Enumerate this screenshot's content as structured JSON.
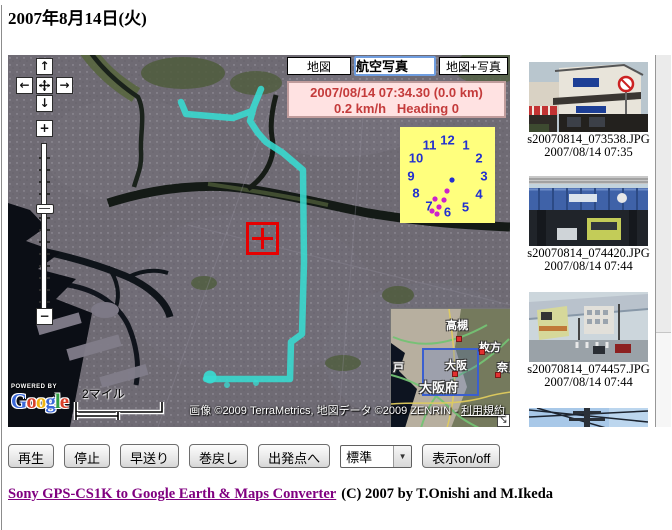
{
  "page": {
    "title": "2007年8月14日(火)"
  },
  "icons": {
    "pan_up": "↑",
    "pan_left": "←",
    "pan_right": "→",
    "pan_down": "↓",
    "zoom_in": "+",
    "zoom_out": "−",
    "select_arrow": "▼",
    "overview_collapse": "↘"
  },
  "map": {
    "type_buttons": [
      {
        "label": "地図",
        "selected": false
      },
      {
        "label": "航空写真",
        "selected": true
      },
      {
        "label": "地図+写真",
        "selected": false
      }
    ],
    "status": {
      "line1": "2007/08/14 07:34.30 (0.0 km)",
      "line2": "0.2 km/h   Heading 0"
    },
    "clock": {
      "numbers": [
        "1",
        "2",
        "3",
        "4",
        "5",
        "6",
        "7",
        "8",
        "9",
        "10",
        "11",
        "12"
      ],
      "center_dot": [
        52,
        53
      ],
      "hand_dots": [
        [
          47,
          64
        ],
        [
          44,
          73
        ],
        [
          35,
          72
        ],
        [
          39,
          80
        ],
        [
          32,
          84
        ],
        [
          37,
          87
        ]
      ]
    },
    "track": {
      "color": "#38dcd2",
      "points": [
        [
          173,
          47
        ],
        [
          178,
          59
        ],
        [
          225,
          63
        ],
        [
          244,
          56
        ],
        [
          253,
          34
        ],
        [
          246,
          51
        ],
        [
          242,
          66
        ],
        [
          250,
          78
        ],
        [
          258,
          87
        ],
        [
          275,
          98
        ],
        [
          295,
          115
        ],
        [
          296,
          207
        ],
        [
          294,
          279
        ],
        [
          283,
          287
        ],
        [
          282,
          324
        ],
        [
          198,
          324
        ]
      ],
      "end_dot": [
        202,
        322
      ],
      "stray_dots": [
        [
          219,
          330
        ],
        [
          248,
          328
        ]
      ]
    },
    "scale_label": "2マイル",
    "google_logo": {
      "powered_by": "POWERED BY",
      "letters": [
        {
          "ch": "G",
          "color": "#3b68d8"
        },
        {
          "ch": "o",
          "color": "#d8402a"
        },
        {
          "ch": "o",
          "color": "#f0b411"
        },
        {
          "ch": "g",
          "color": "#3b68d8"
        },
        {
          "ch": "l",
          "color": "#2f9e44"
        },
        {
          "ch": "e",
          "color": "#d8402a"
        }
      ]
    },
    "attribution": {
      "text": "画像 ©2009 TerraMetrics, 地図データ ©2009 ZENRIN - ",
      "terms": "利用規約"
    },
    "minimap": {
      "labels": [
        {
          "text": "高槻",
          "x": 55,
          "y": 8,
          "size": 11
        },
        {
          "text": "枚方",
          "x": 88,
          "y": 30,
          "size": 11
        },
        {
          "text": "奈良",
          "x": 106,
          "y": 50,
          "size": 11
        },
        {
          "text": "大阪",
          "x": 54,
          "y": 48,
          "size": 11
        },
        {
          "text": "大阪府",
          "x": 28,
          "y": 68,
          "size": 13
        },
        {
          "text": "戸",
          "x": 2,
          "y": 50,
          "size": 11
        }
      ],
      "dots": [
        [
          65,
          27
        ],
        [
          88,
          40
        ],
        [
          104,
          63
        ],
        [
          61,
          62
        ]
      ]
    }
  },
  "photos": [
    {
      "file": "s20070814_073538.JPG",
      "time": "2007/08/14 07:35"
    },
    {
      "file": "s20070814_074420.JPG",
      "time": "2007/08/14 07:44"
    },
    {
      "file": "s20070814_074457.JPG",
      "time": "2007/08/14 07:44"
    },
    {
      "file": "",
      "time": ""
    }
  ],
  "controls": {
    "buttons": [
      "再生",
      "停止",
      "早送り",
      "巻戻し",
      "出発点へ"
    ],
    "speed_select": "標準",
    "toggle_button": "表示on/off"
  },
  "footer": {
    "link": "Sony GPS-CS1K to Google Earth & Maps Converter",
    "text": "(C) 2007 by T.Onishi and M.Ikeda"
  },
  "colors": {
    "track": "#38dcd2",
    "marker": "#e60000",
    "status_bg": "#ffe2e2",
    "status_text": "#c43b3b",
    "clock_bg": "#ffff7d",
    "clock_numbers": "#2230cf",
    "hand_dots": "#cc22cc",
    "link": "#800080",
    "minimap_viewport": "#3a5fd0"
  }
}
